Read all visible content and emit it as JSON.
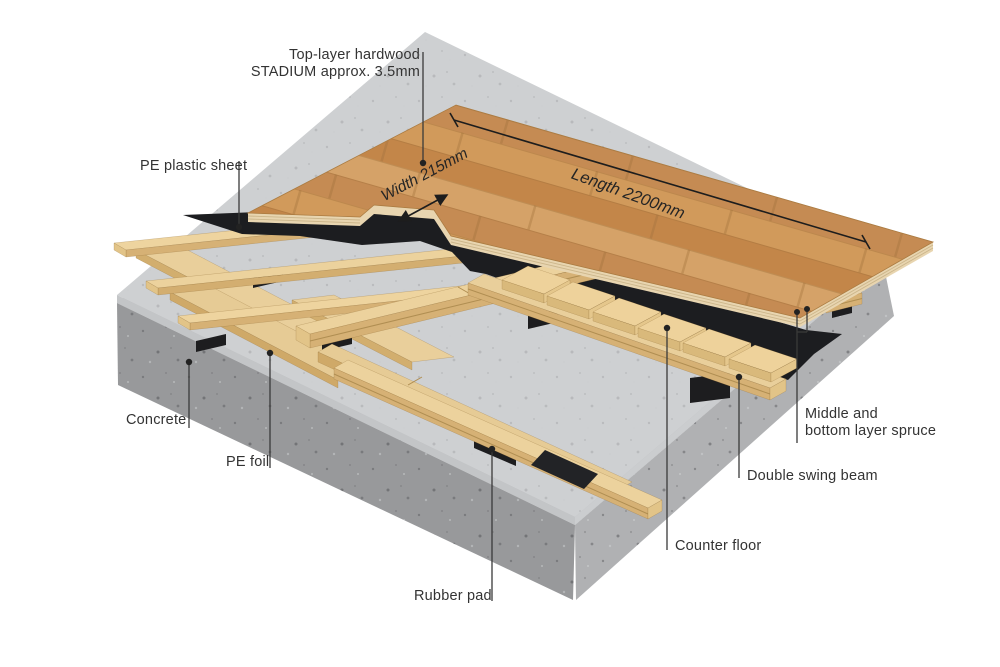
{
  "diagram": {
    "title_context": "sports floor construction cutaway",
    "labels": {
      "top_layer": {
        "line1": "Top-layer hardwood",
        "line2": "STADIUM approx. 3.5mm"
      },
      "pe_plastic_sheet": "PE plastic sheet",
      "concrete": "Concrete",
      "pe_foil": "PE foil",
      "rubber_pad": "Rubber pad",
      "counter_floor": "Counter floor",
      "double_swing_beam": "Double swing beam",
      "middle_bottom_spruce": {
        "line1": "Middle and",
        "line2": "bottom layer spruce"
      }
    },
    "dimensions": {
      "width": {
        "line1": "Width",
        "line2": "215mm"
      },
      "length": {
        "text": "Length 2200mm"
      }
    },
    "colors": {
      "oak_parquet": "#c98e4d",
      "spruce_wood": "#ecd29d",
      "pe_sheet_black": "#222326",
      "concrete_grey": "#a6a7a9",
      "pe_foil_grey": "#ced0d2",
      "label_text": "#333333"
    }
  }
}
